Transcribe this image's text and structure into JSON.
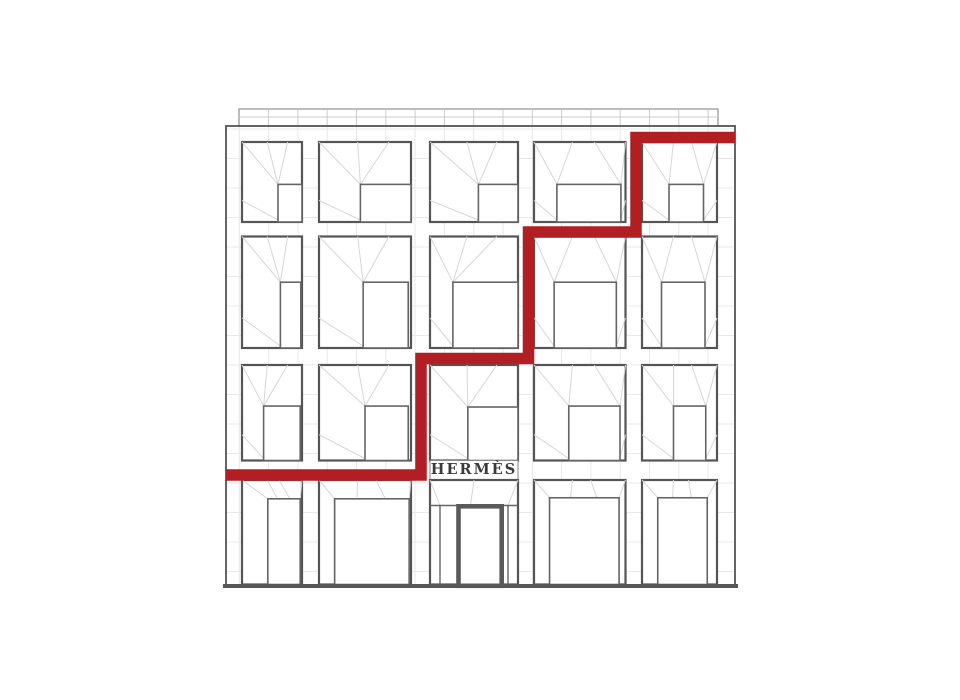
{
  "title": "Hermes building facade line drawing with red stepped line",
  "sign": {
    "label": "HERMÈS",
    "color": "#3a3a3a"
  },
  "palette": {
    "background": "#ffffff",
    "frame": "#545454",
    "inner_frame": "#656565",
    "fan_line": "#d6d6d6",
    "grid_line": "#e8e8e8",
    "parapet_line": "#909090",
    "parapet_tick": "#cccccc",
    "ground_line": "#575757",
    "door_frame": "#5a5a5a",
    "red": "#b11f24"
  },
  "facade": {
    "x": 226,
    "y": 126,
    "w": 509,
    "h": 459,
    "grid_x0": 239.3,
    "grid_dx": 29.3,
    "grid_y0": 129,
    "grid_dy": 29.5
  },
  "parapet": {
    "x": 239,
    "y": 109,
    "w": 479,
    "h": 17,
    "mid_y": 117
  },
  "ground": {
    "y": 586,
    "thickness": 4,
    "x1": 223,
    "x2": 738
  },
  "columns": [
    {
      "x": 242,
      "w": 60
    },
    {
      "x": 319,
      "w": 92
    },
    {
      "x": 430,
      "w": 88
    },
    {
      "x": 534,
      "w": 91.5
    },
    {
      "x": 642,
      "w": 75
    }
  ],
  "rows": [
    {
      "y": 142,
      "h": 80
    },
    {
      "y": 236.5,
      "h": 111.5
    },
    {
      "y": 365,
      "h": 95.5
    },
    {
      "y": 480,
      "h": 104.5
    }
  ],
  "windows": [
    {
      "r": 0,
      "c": 0,
      "inner": {
        "l": 0.6,
        "rt": 1.0,
        "t": 0.53
      }
    },
    {
      "r": 0,
      "c": 1,
      "inner": {
        "l": 0.45,
        "rt": 1.0,
        "t": 0.53
      }
    },
    {
      "r": 0,
      "c": 2,
      "inner": {
        "l": 0.55,
        "rt": 1.0,
        "t": 0.53
      }
    },
    {
      "r": 0,
      "c": 3,
      "inner": {
        "l": 0.25,
        "rt": 0.95,
        "t": 0.53
      }
    },
    {
      "r": 0,
      "c": 4,
      "inner": {
        "l": 0.36,
        "rt": 0.82,
        "t": 0.53
      }
    },
    {
      "r": 1,
      "c": 0,
      "inner": {
        "l": 0.64,
        "rt": 0.98,
        "t": 0.41
      }
    },
    {
      "r": 1,
      "c": 1,
      "inner": {
        "l": 0.48,
        "rt": 0.97,
        "t": 0.41
      }
    },
    {
      "r": 1,
      "c": 2,
      "inner": {
        "l": 0.26,
        "rt": 1.0,
        "t": 0.41
      }
    },
    {
      "r": 1,
      "c": 3,
      "inner": {
        "l": 0.22,
        "rt": 0.9,
        "t": 0.41
      }
    },
    {
      "r": 1,
      "c": 4,
      "inner": {
        "l": 0.26,
        "rt": 0.84,
        "t": 0.41
      }
    },
    {
      "r": 2,
      "c": 0,
      "inner": {
        "l": 0.36,
        "rt": 0.97,
        "t": 0.43
      }
    },
    {
      "r": 2,
      "c": 1,
      "inner": {
        "l": 0.5,
        "rt": 0.97,
        "t": 0.43
      }
    },
    {
      "r": 2,
      "c": 2,
      "inner": {
        "l": 0.43,
        "rt": 1.0,
        "t": 0.44
      }
    },
    {
      "r": 2,
      "c": 3,
      "inner": {
        "l": 0.38,
        "rt": 0.94,
        "t": 0.43
      }
    },
    {
      "r": 2,
      "c": 4,
      "inner": {
        "l": 0.42,
        "rt": 0.85,
        "t": 0.43
      }
    },
    {
      "r": 3,
      "c": 0,
      "inner": {
        "l": 0.43,
        "rt": 0.97,
        "t": 0.18
      }
    },
    {
      "r": 3,
      "c": 1,
      "inner": {
        "l": 0.17,
        "rt": 0.98,
        "t": 0.18
      }
    },
    {
      "r": 3,
      "c": 3,
      "inner": {
        "l": 0.17,
        "rt": 0.93,
        "t": 0.17
      }
    },
    {
      "r": 3,
      "c": 4,
      "inner": {
        "l": 0.21,
        "rt": 0.87,
        "t": 0.17
      }
    }
  ],
  "sign_band": {
    "x": 430,
    "y": 460.5,
    "w": 88,
    "h": 19.5
  },
  "door_bay": {
    "r": 3,
    "c": 2,
    "transom_y": 505.5,
    "mullion_left_x": 440,
    "mullion_right_x": 508,
    "door": {
      "x": 458.5,
      "y": 506.3,
      "w": 43.2,
      "h": 79.5,
      "frame_w": 4.6
    }
  },
  "red_line": {
    "thickness": 11.5,
    "points": [
      [
        226,
        475
      ],
      [
        421,
        475
      ],
      [
        421,
        358.5
      ],
      [
        528.5,
        358.5
      ],
      [
        528.5,
        232
      ],
      [
        636,
        232
      ],
      [
        636,
        137.5
      ],
      [
        735,
        137.5
      ]
    ]
  }
}
